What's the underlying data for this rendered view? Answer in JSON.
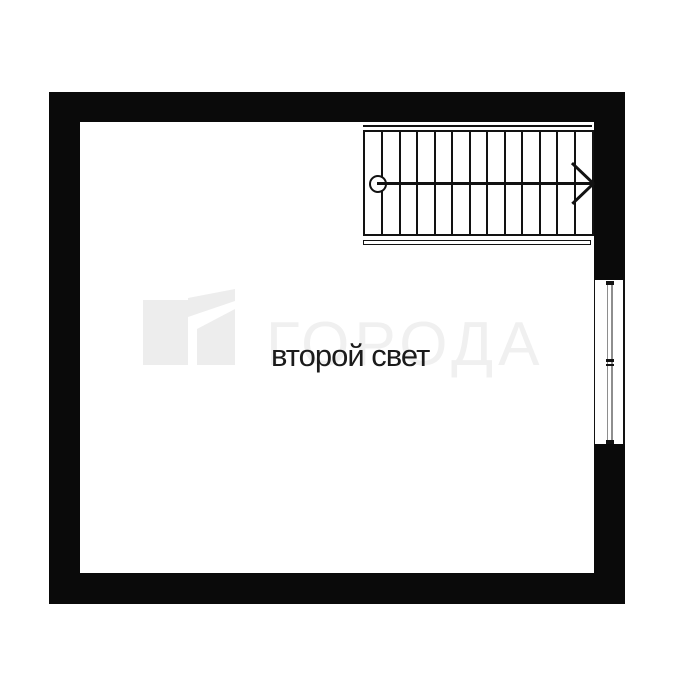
{
  "canvas": {
    "width": 675,
    "height": 675,
    "background": "#ffffff"
  },
  "plan": {
    "room_label": "второй свет",
    "wall_color": "#0a0a0a",
    "line_color": "#121212"
  },
  "stair": {
    "steps": 13,
    "direction_symbol": "circle-to-arrow-right"
  },
  "window": {
    "glazing_color": "#8e8e8e"
  },
  "watermark": {
    "text": "ГОРОДА",
    "text_color": "#f0f0f0",
    "logo_color": "#ededed"
  }
}
